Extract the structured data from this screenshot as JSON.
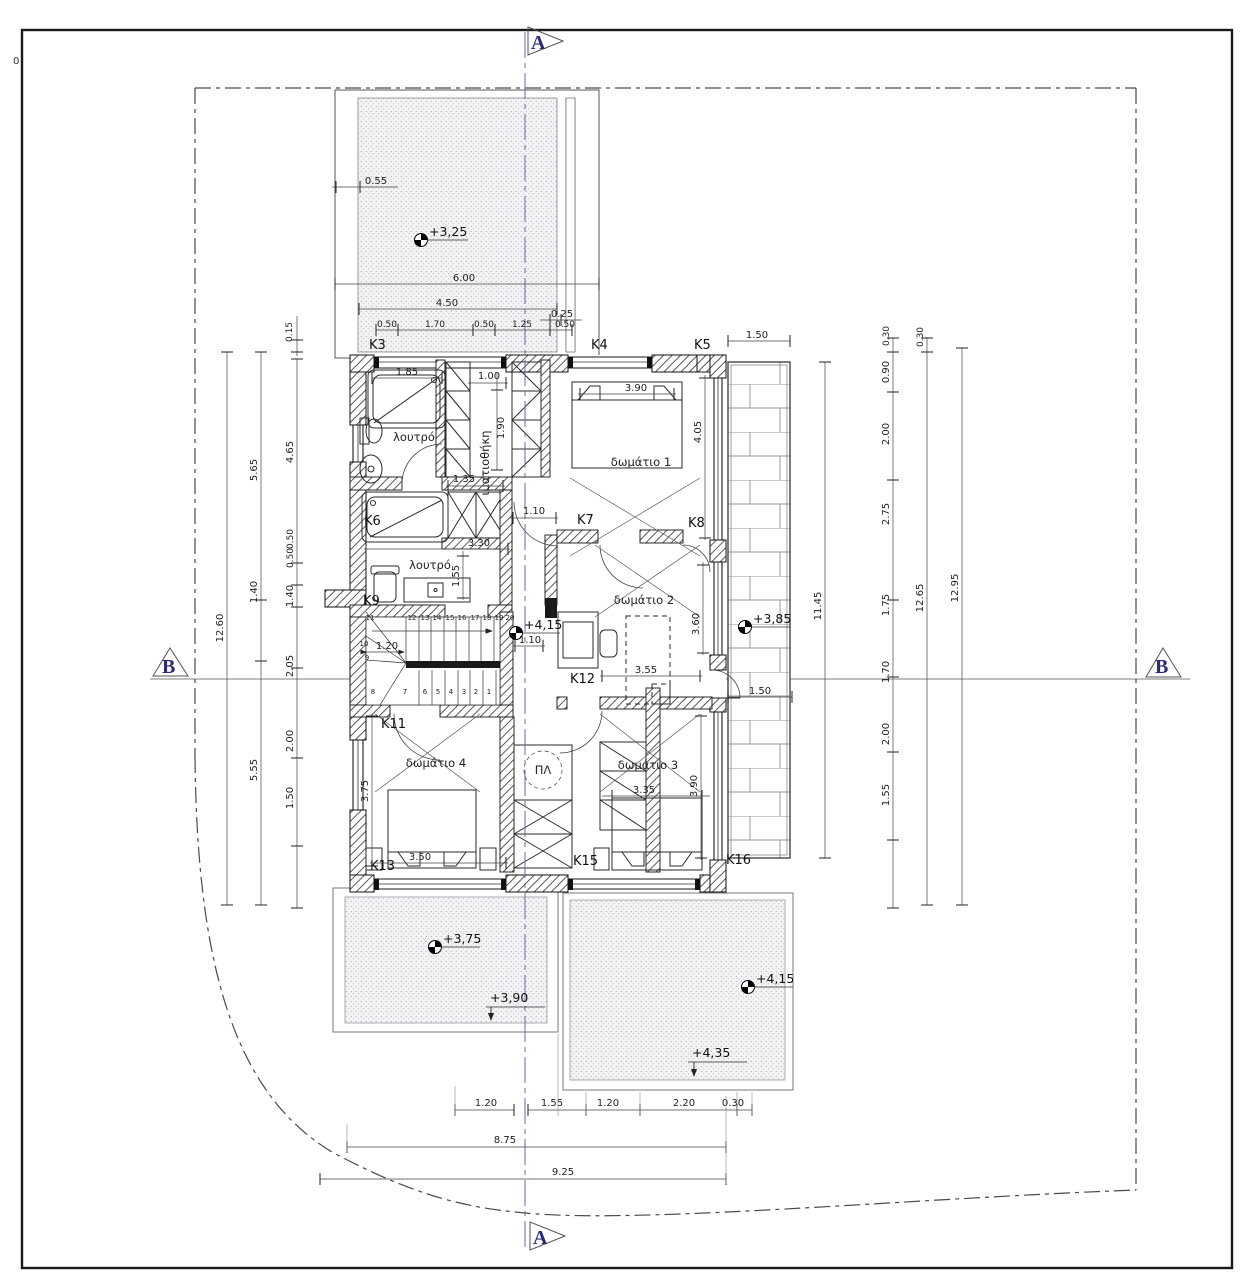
{
  "frame": {
    "margin_label": "0"
  },
  "sections": {
    "a": "A",
    "b": "B"
  },
  "levels": {
    "top_balcony": "+3,25",
    "hall": "+4,15",
    "right_balcony": "+3,85",
    "terrace_left": "+3,75",
    "terrace_left_edge": "+3,90",
    "terrace_right": "+4,15",
    "terrace_right_edge": "+4,35"
  },
  "rooms": {
    "bath1": "λουτρό",
    "wardrobe": "ιματιοθήκη",
    "room1": "δωμάτιο 1",
    "room2": "δωμάτιο 2",
    "bath2": "λουτρό",
    "room3": "δωμάτιο 3",
    "room4": "δωμάτιο 4",
    "shaft": "ΠΛ"
  },
  "openings": {
    "k3": "K3",
    "k4": "K4",
    "k5": "K5",
    "k6": "K6",
    "k7": "K7",
    "k8": "K8",
    "k9": "K9",
    "k11": "K11",
    "k12": "K12",
    "k13": "K13",
    "k15": "K15",
    "k16": "K16"
  },
  "stairs": {
    "upper": [
      "11",
      "12",
      "13",
      "14",
      "15",
      "16",
      "17",
      "18",
      "19",
      "20"
    ],
    "lower": [
      "8",
      "7",
      "6",
      "5",
      "4",
      "3",
      "2",
      "1"
    ],
    "side": [
      "10",
      "9"
    ]
  },
  "dims": {
    "top": {
      "wall": "0.55",
      "total": "6.00",
      "inner": "4.50",
      "step": "0.25",
      "chain": [
        "0.50",
        "1.70",
        "0.50",
        "1.25",
        "0.50"
      ],
      "offset": "0.15",
      "balcony": "1.50"
    },
    "left": {
      "total": "12.60",
      "mid": [
        "5.65",
        "1.40",
        "5.55"
      ],
      "inner": [
        "4.65",
        "0.50",
        "0.50",
        "1.40",
        "2.05",
        "2.00",
        "1.50"
      ]
    },
    "right": {
      "chain": [
        "0.30",
        "0.90",
        "2.00",
        "2.75",
        "1.75",
        "1.70",
        "2.00",
        "1.55"
      ],
      "mid_offset": "0.30",
      "mid": "12.65",
      "outer": "12.95",
      "balcony_h": "11.45",
      "balcony_door": "1.50"
    },
    "interior": {
      "tub": "1.85",
      "ward_w": "1.00",
      "ward_d": "1.90",
      "hall_w": "1.35",
      "door1": "1.10",
      "bath2_w": "3.30",
      "vanity": "1.55",
      "bed1": "3.90",
      "room1_d": "4.05",
      "bed2": "3.55",
      "room2_d": "3.60",
      "stair_w": "1.20",
      "door2": "1.10",
      "room4_d": "3.75",
      "bed4": "3.50",
      "bed3": "3.35",
      "room3_d": "3.90"
    },
    "bottom": {
      "chain": [
        "1.20",
        "1.55",
        "1.20",
        "2.20",
        "0.30"
      ],
      "sub": "8.75",
      "total": "9.25"
    }
  }
}
